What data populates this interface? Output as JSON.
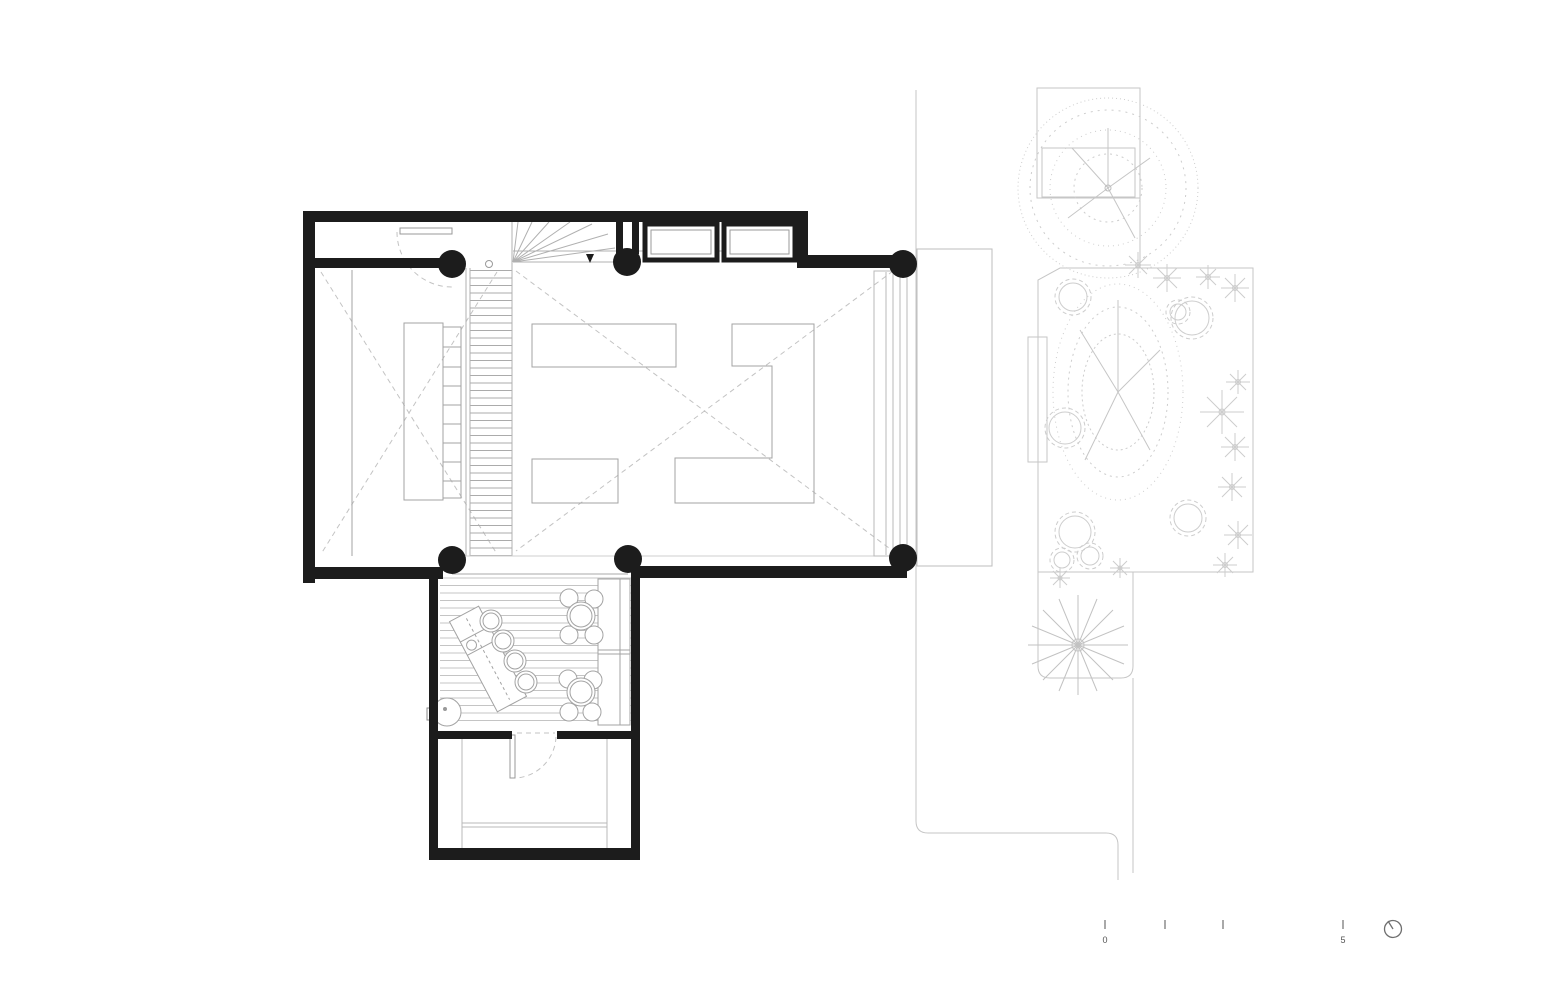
{
  "drawing": {
    "kind_label": "floor-plan"
  },
  "scale_bar": {
    "start_label": "0",
    "end_label": "5"
  },
  "icons": {
    "north_icon": "circle-with-needle"
  },
  "palette": {
    "wall": "#1c1c1c",
    "furniture_line": "#a3a3a3",
    "stair_line": "#b0b0b0",
    "deck_line": "#c0c0c0",
    "dashed_line": "#c3c3c3",
    "site_line": "#c6c6c6",
    "vegetation_line": "#cdcdcd",
    "annotation": "#6f6f6f",
    "paper": "#ffffff"
  }
}
